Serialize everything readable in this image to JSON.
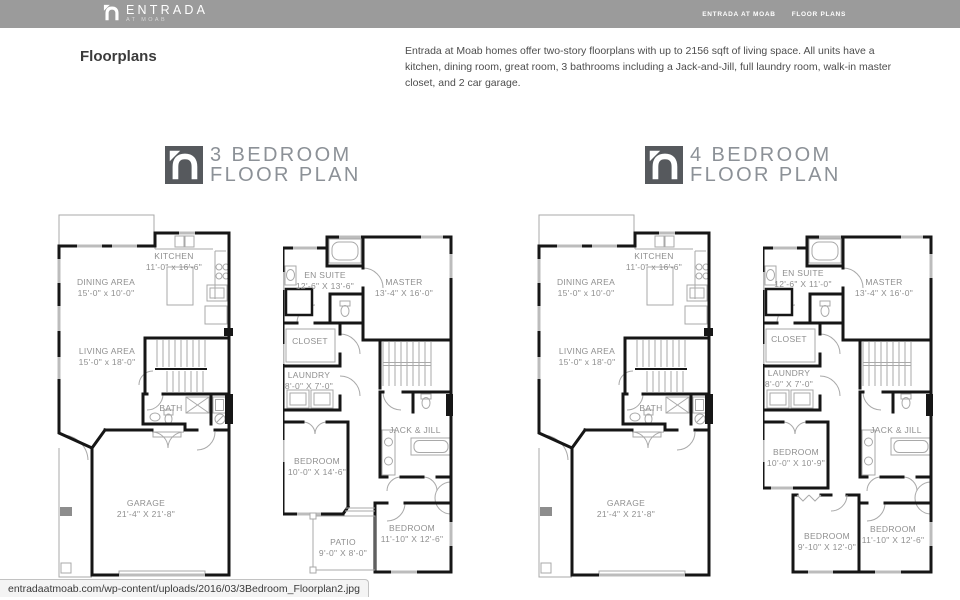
{
  "header": {
    "brand": "ENTRADA",
    "brand_sub": "AT MOAB",
    "nav": [
      {
        "label": "ENTRADA AT MOAB"
      },
      {
        "label": "FLOOR PLANS"
      }
    ]
  },
  "page": {
    "heading": "Floorplans",
    "description": "Entrada at Moab homes offer two-story floorplans with up to 2156 sqft of living space.  All units have a kitchen, dining room, great room, 3 bathrooms including a Jack-and-Jill, full laundry room, walk-in master closet, and 2 car garage."
  },
  "status_bar": {
    "url": "entradaatmoab.com/wp-content/uploads/2016/03/3Bedroom_Floorplan2.jpg"
  },
  "plans": [
    {
      "id": "plan-3br",
      "title_line1": "3 BEDROOM",
      "title_line2": "FLOOR PLAN",
      "variant": "patio",
      "floor1_labels": [
        {
          "text": "KITCHEN",
          "dims": "11'-0\" x 16'-6\"",
          "x": 117,
          "y": 40
        },
        {
          "text": "DINING AREA",
          "dims": "15'-0\" x 10'-0\"",
          "x": 49,
          "y": 66
        },
        {
          "text": "LIVING AREA",
          "dims": "15'-0\" x 18'-0\"",
          "x": 50,
          "y": 135
        },
        {
          "text": "BATH",
          "dims": "",
          "x": 114,
          "y": 192
        },
        {
          "text": "GARAGE",
          "dims": "21'-4\" X 21'-8\"",
          "x": 89,
          "y": 287
        }
      ],
      "floor2_labels": [
        {
          "text": "EN SUITE",
          "dims": "12'-6\" X 13'-6\"",
          "x": 42,
          "y": 40
        },
        {
          "text": "MASTER",
          "dims": "13'-4\" X 16'-0\"",
          "x": 121,
          "y": 47
        },
        {
          "text": "CLOSET",
          "dims": "",
          "x": 27,
          "y": 106
        },
        {
          "text": "LAUNDRY",
          "dims": "8'-0\" X 7'-0\"",
          "x": 26,
          "y": 140
        },
        {
          "text": "JACK & JILL",
          "dims": "",
          "x": 132,
          "y": 195
        },
        {
          "text": "BEDROOM",
          "dims": "10'-0\" X 14'-6\"",
          "x": 34,
          "y": 226
        },
        {
          "text": "PATIO",
          "dims": "9'-0\" X 8'-0\"",
          "x": 60,
          "y": 307
        },
        {
          "text": "BEDROOM",
          "dims": "11'-10\" X 12'-6\"",
          "x": 129,
          "y": 293
        }
      ]
    },
    {
      "id": "plan-4br",
      "title_line1": "4 BEDROOM",
      "title_line2": "FLOOR PLAN",
      "variant": "bed4",
      "floor1_labels": [
        {
          "text": "KITCHEN",
          "dims": "11'-0\" x 16'-6\"",
          "x": 117,
          "y": 40
        },
        {
          "text": "DINING AREA",
          "dims": "15'-0\" x 10'-0\"",
          "x": 49,
          "y": 66
        },
        {
          "text": "LIVING AREA",
          "dims": "15'-0\" x 18'-0\"",
          "x": 50,
          "y": 135
        },
        {
          "text": "BATH",
          "dims": "",
          "x": 114,
          "y": 192
        },
        {
          "text": "GARAGE",
          "dims": "21'-4\" X 21'-8\"",
          "x": 89,
          "y": 287
        }
      ],
      "floor2_labels": [
        {
          "text": "EN SUITE",
          "dims": "12'-6\" X 11'-0\"",
          "x": 40,
          "y": 38
        },
        {
          "text": "MASTER",
          "dims": "13'-4\" X 16'-0\"",
          "x": 121,
          "y": 47
        },
        {
          "text": "CLOSET",
          "dims": "",
          "x": 26,
          "y": 104
        },
        {
          "text": "LAUNDRY",
          "dims": "8'-0\" X 7'-0\"",
          "x": 26,
          "y": 138
        },
        {
          "text": "JACK & JILL",
          "dims": "",
          "x": 133,
          "y": 195
        },
        {
          "text": "BEDROOM",
          "dims": "10'-0\" X 10'-9\"",
          "x": 33,
          "y": 217
        },
        {
          "text": "BEDROOM",
          "dims": "9'-10\" X 12'-0\"",
          "x": 64,
          "y": 301
        },
        {
          "text": "BEDROOM",
          "dims": "11'-10\" X 12'-6\"",
          "x": 130,
          "y": 294
        }
      ]
    }
  ]
}
